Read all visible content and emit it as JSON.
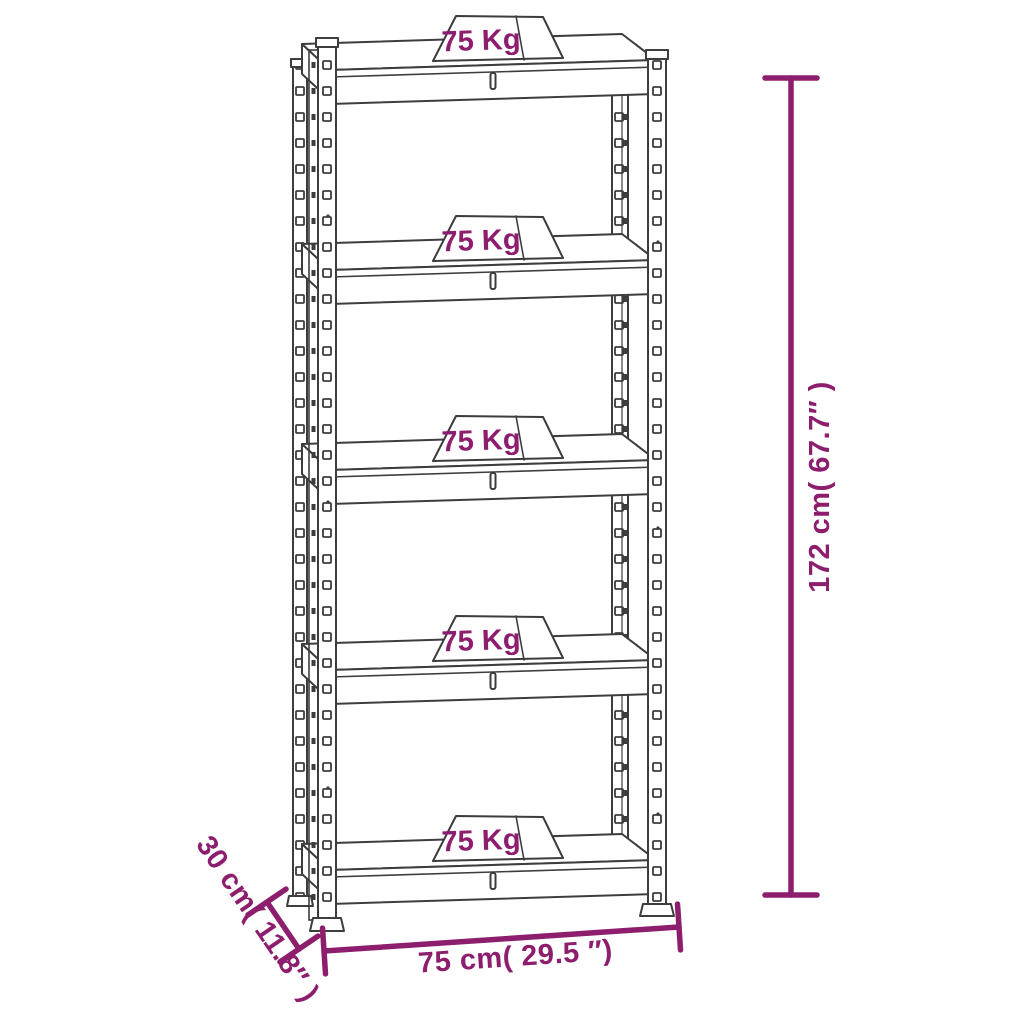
{
  "diagram": {
    "description": "5-tier storage shelf dimension drawing",
    "shelves": [
      {
        "capacity": "75 Kg"
      },
      {
        "capacity": "75 Kg"
      },
      {
        "capacity": "75 Kg"
      },
      {
        "capacity": "75 Kg"
      },
      {
        "capacity": "75 Kg"
      }
    ],
    "dimensions": {
      "height": "172 cm( 67.7″ )",
      "width": "75 cm( 29.5 ″)",
      "depth": "30 cm( 11.8″ )"
    },
    "colors": {
      "annotation": "#8d1d6d",
      "line_art": "#3d3d3d",
      "background": "#ffffff"
    }
  }
}
